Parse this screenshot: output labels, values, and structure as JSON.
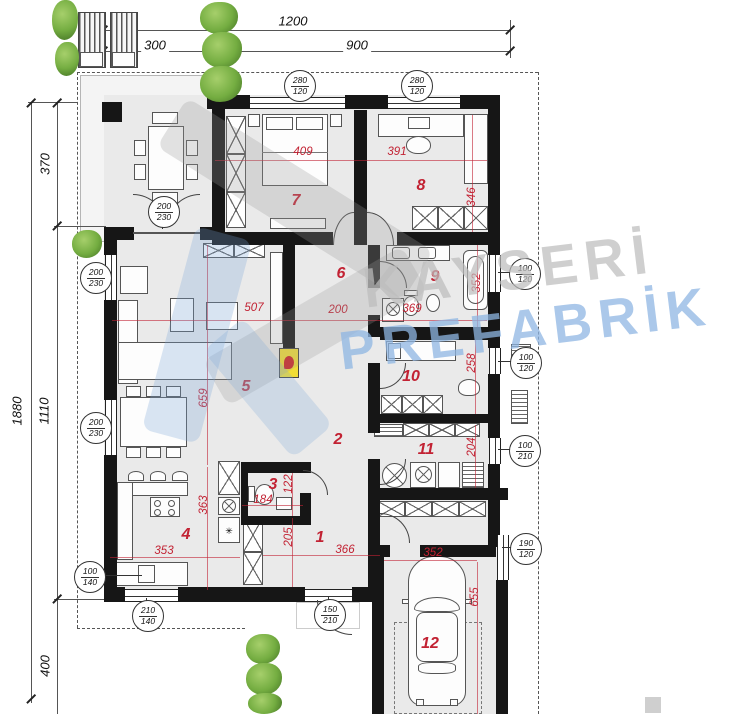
{
  "watermark": {
    "line1": "KAYSERİ",
    "line2": "PREFABRİK"
  },
  "colors": {
    "dim_red": "#c22233",
    "wall": "#161616",
    "room_fill": "#eaeaea",
    "plant_green": "#74ad41",
    "watermark_gray": "#bdbdbd",
    "watermark_blue": "#8fb6e3",
    "fireplace_yellow": "#f0dd36"
  },
  "site_dims": [
    {
      "t": "1200",
      "x": 293,
      "y": 21,
      "r": 0
    },
    {
      "t": "300",
      "x": 155,
      "y": 45,
      "r": 0
    },
    {
      "t": "900",
      "x": 357,
      "y": 45,
      "r": 0
    },
    {
      "t": "370",
      "x": 45,
      "y": 164,
      "r": -90
    },
    {
      "t": "1110",
      "x": 44,
      "y": 411,
      "r": -90
    },
    {
      "t": "1880",
      "x": 17,
      "y": 411,
      "r": -90
    },
    {
      "t": "400",
      "x": 45,
      "y": 666,
      "r": -90
    }
  ],
  "room_numbers": [
    {
      "n": "1",
      "x": 320,
      "y": 538
    },
    {
      "n": "2",
      "x": 338,
      "y": 440
    },
    {
      "n": "3",
      "x": 273,
      "y": 485
    },
    {
      "n": "4",
      "x": 186,
      "y": 535
    },
    {
      "n": "5",
      "x": 246,
      "y": 387
    },
    {
      "n": "6",
      "x": 341,
      "y": 274
    },
    {
      "n": "7",
      "x": 296,
      "y": 201
    },
    {
      "n": "8",
      "x": 421,
      "y": 186
    },
    {
      "n": "9",
      "x": 435,
      "y": 277
    },
    {
      "n": "10",
      "x": 411,
      "y": 377
    },
    {
      "n": "11",
      "x": 426,
      "y": 450
    },
    {
      "n": "12",
      "x": 430,
      "y": 644
    }
  ],
  "dims": [
    {
      "t": "409",
      "x": 303,
      "y": 152,
      "r": 0
    },
    {
      "t": "391",
      "x": 397,
      "y": 152,
      "r": 0
    },
    {
      "t": "346",
      "x": 472,
      "y": 197,
      "r": -90
    },
    {
      "t": "507",
      "x": 254,
      "y": 308,
      "r": 0
    },
    {
      "t": "200",
      "x": 338,
      "y": 310,
      "r": 0
    },
    {
      "t": "369",
      "x": 412,
      "y": 309,
      "r": 0
    },
    {
      "t": "352",
      "x": 477,
      "y": 283,
      "r": -90
    },
    {
      "t": "659",
      "x": 204,
      "y": 398,
      "r": -90
    },
    {
      "t": "363",
      "x": 204,
      "y": 505,
      "r": -90
    },
    {
      "t": "258",
      "x": 472,
      "y": 363,
      "r": -90
    },
    {
      "t": "204",
      "x": 472,
      "y": 447,
      "r": -90
    },
    {
      "t": "184",
      "x": 263,
      "y": 500,
      "r": 0
    },
    {
      "t": "122",
      "x": 289,
      "y": 484,
      "r": -90
    },
    {
      "t": "205",
      "x": 289,
      "y": 537,
      "r": -90
    },
    {
      "t": "366",
      "x": 345,
      "y": 550,
      "r": 0
    },
    {
      "t": "353",
      "x": 164,
      "y": 551,
      "r": 0
    },
    {
      "t": "352",
      "x": 433,
      "y": 553,
      "r": 0
    },
    {
      "t": "655",
      "x": 475,
      "y": 597,
      "r": -90
    }
  ],
  "window_markers": [
    {
      "top": "280",
      "bot": "120",
      "x": 299,
      "y": 85
    },
    {
      "top": "280",
      "bot": "120",
      "x": 416,
      "y": 85
    },
    {
      "top": "200",
      "bot": "230",
      "x": 163,
      "y": 211
    },
    {
      "top": "200",
      "bot": "230",
      "x": 95,
      "y": 277
    },
    {
      "top": "200",
      "bot": "230",
      "x": 95,
      "y": 427
    },
    {
      "top": "100",
      "bot": "140",
      "x": 89,
      "y": 576
    },
    {
      "top": "210",
      "bot": "140",
      "x": 147,
      "y": 615
    },
    {
      "top": "150",
      "bot": "210",
      "x": 329,
      "y": 614
    },
    {
      "top": "100",
      "bot": "120",
      "x": 524,
      "y": 273
    },
    {
      "top": "100",
      "bot": "120",
      "x": 525,
      "y": 362
    },
    {
      "top": "100",
      "bot": "210",
      "x": 524,
      "y": 450
    },
    {
      "top": "190",
      "bot": "120",
      "x": 525,
      "y": 548
    }
  ]
}
